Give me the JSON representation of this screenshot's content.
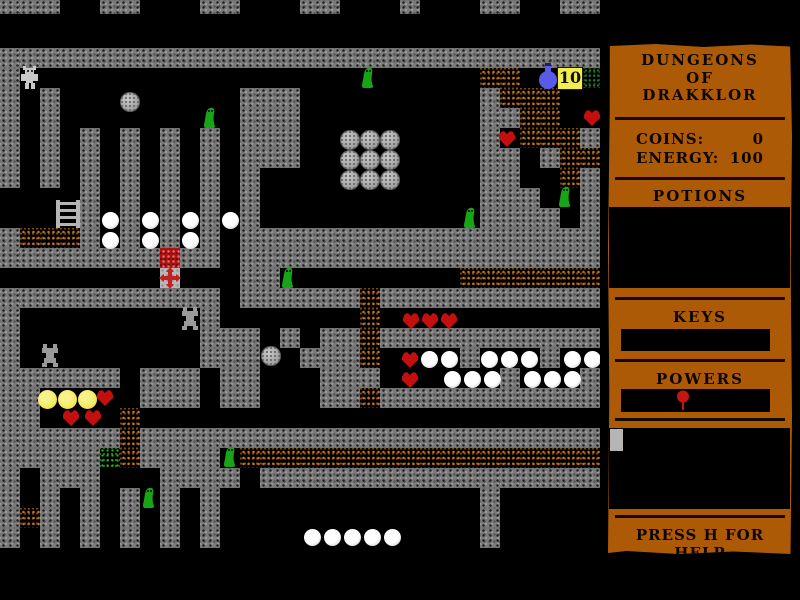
{
  "window": {
    "width": 800,
    "height": 600,
    "background": "#000000"
  },
  "sidebar": {
    "title_lines": [
      "DUNGEONS",
      "OF",
      "DRAKKLOR"
    ],
    "stats": [
      {
        "label": "COINS:",
        "value": "0"
      },
      {
        "label": "ENERGY:",
        "value": "100"
      }
    ],
    "potions_heading": "POTIONS",
    "keys_heading": "KEYS",
    "powers_heading": "POWERS",
    "help_text": "PRESS H FOR HELP",
    "power_icon": "red-balloon-icon",
    "panel_color": "#ad5a07"
  },
  "hud": {
    "potion_count": "10"
  },
  "colors": {
    "panel": "#ad5a07",
    "divider": "#140a00",
    "text": "#0c0500",
    "box": "#000000",
    "cursor": "#b5b5b5",
    "wall_base": "#7b7b7b",
    "rubble_speck": "#c9731a",
    "green_speck": "#2db52d",
    "dark_green_speck": "#1f7a1f",
    "red_tile": "#a81212",
    "gray_tile": "#b8b8b8",
    "heart": "#c40f0f",
    "slime": "#17a417",
    "slime_eye": "#0a2a0a",
    "coin": "#f2e84e",
    "egg": "#f8f8f8",
    "boulder": "#ababab",
    "player": "#c8c8c8",
    "spider": "#9a9a9a",
    "flask": "#5a5ae8",
    "flask_cap": "#202060",
    "badge_bg": "#f3ee4e",
    "badge_text": "#111111",
    "balloon": "#c41414",
    "ladder": "#b5b5b5",
    "cross": "#c42020"
  },
  "map": {
    "tile_size": 20,
    "cols": 30,
    "row_y_offset": -12,
    "legend": {
      "#": "wall",
      ".": "floor",
      "o": "rubble",
      "g": "green-speckle",
      "D": "dark-green-speckle",
      "%": "red-chest",
      "+": "cross-base"
    },
    "rows": [
      "###..##...##...##...#...##..##",
      "..............................",
      "..............................",
      "##############################",
      "#.......................oo...D",
      "#.#.........###.........#ooo..",
      "#.#.........###.........##oo..",
      "#.#.#.#.#.#.###.........#.ooo#",
      "#.#.#.#.#.#.###.........##.#oo",
      "#.#.#.#.#.#.#...........##..o#",
      "....#.#.#.#.#...........###..#",
      "....#.#.#.#.#...........####.#",
      "#ooo#.#.#.#.##################",
      "########%##.##################",
      "........+...##.........ooooooo",
      "###########.######o###########",
      "#.........#.......o...........",
      "#.........###.#.##o###########",
      "#.........###..###o....#...#..",
      "######.###.##...###......#...#",
      "##.....###.##...##o###########",
      "##....o.......................",
      "######o#######################",
      "#####go####.oooooooooooooooooo",
      "#.###...####.#################",
      "#.#.#.#.#.#.............#.....",
      "#o#.#.#.#.#.............#.....",
      "#.#.#.#.#.#.............#.....",
      "..............................",
      "..............................",
      ".............................."
    ],
    "entities": [
      {
        "type": "player",
        "x": 21,
        "y": 66
      },
      {
        "type": "slime",
        "x": 202,
        "y": 106
      },
      {
        "type": "slime",
        "x": 360,
        "y": 66
      },
      {
        "type": "slime",
        "x": 462,
        "y": 206
      },
      {
        "type": "slime",
        "x": 557,
        "y": 185
      },
      {
        "type": "slime",
        "x": 280,
        "y": 266
      },
      {
        "type": "slime",
        "x": 222,
        "y": 445
      },
      {
        "type": "slime",
        "x": 141,
        "y": 486
      },
      {
        "type": "spider",
        "x": 179,
        "y": 307
      },
      {
        "type": "spider",
        "x": 39,
        "y": 344
      },
      {
        "type": "boulder",
        "x": 120,
        "y": 92
      },
      {
        "type": "boulder",
        "x": 340,
        "y": 130
      },
      {
        "type": "boulder",
        "x": 360,
        "y": 130
      },
      {
        "type": "boulder",
        "x": 380,
        "y": 130
      },
      {
        "type": "boulder",
        "x": 340,
        "y": 150
      },
      {
        "type": "boulder",
        "x": 360,
        "y": 150
      },
      {
        "type": "boulder",
        "x": 380,
        "y": 150
      },
      {
        "type": "boulder",
        "x": 340,
        "y": 170
      },
      {
        "type": "boulder",
        "x": 360,
        "y": 170
      },
      {
        "type": "boulder",
        "x": 380,
        "y": 170
      },
      {
        "type": "boulder",
        "x": 261,
        "y": 346
      },
      {
        "type": "egg",
        "x": 102,
        "y": 212
      },
      {
        "type": "egg",
        "x": 142,
        "y": 212
      },
      {
        "type": "egg",
        "x": 182,
        "y": 212
      },
      {
        "type": "egg",
        "x": 222,
        "y": 212
      },
      {
        "type": "egg",
        "x": 102,
        "y": 232
      },
      {
        "type": "egg",
        "x": 142,
        "y": 232
      },
      {
        "type": "egg",
        "x": 182,
        "y": 232
      },
      {
        "type": "egg",
        "x": 421,
        "y": 351
      },
      {
        "type": "egg",
        "x": 441,
        "y": 351
      },
      {
        "type": "egg",
        "x": 481,
        "y": 351
      },
      {
        "type": "egg",
        "x": 501,
        "y": 351
      },
      {
        "type": "egg",
        "x": 521,
        "y": 351
      },
      {
        "type": "egg",
        "x": 564,
        "y": 351
      },
      {
        "type": "egg",
        "x": 584,
        "y": 351
      },
      {
        "type": "egg",
        "x": 444,
        "y": 371
      },
      {
        "type": "egg",
        "x": 464,
        "y": 371
      },
      {
        "type": "egg",
        "x": 484,
        "y": 371
      },
      {
        "type": "egg",
        "x": 524,
        "y": 371
      },
      {
        "type": "egg",
        "x": 544,
        "y": 371
      },
      {
        "type": "egg",
        "x": 564,
        "y": 371
      },
      {
        "type": "egg",
        "x": 304,
        "y": 529
      },
      {
        "type": "egg",
        "x": 324,
        "y": 529
      },
      {
        "type": "egg",
        "x": 344,
        "y": 529
      },
      {
        "type": "egg",
        "x": 364,
        "y": 529
      },
      {
        "type": "egg",
        "x": 384,
        "y": 529
      },
      {
        "type": "heart",
        "x": 582,
        "y": 108
      },
      {
        "type": "heart",
        "x": 497,
        "y": 129
      },
      {
        "type": "heart",
        "x": 401,
        "y": 311
      },
      {
        "type": "heart",
        "x": 420,
        "y": 311
      },
      {
        "type": "heart",
        "x": 439,
        "y": 311
      },
      {
        "type": "heart",
        "x": 400,
        "y": 350
      },
      {
        "type": "heart",
        "x": 400,
        "y": 370
      },
      {
        "type": "heart",
        "x": 95,
        "y": 388
      },
      {
        "type": "heart",
        "x": 61,
        "y": 408
      },
      {
        "type": "heart",
        "x": 83,
        "y": 408
      },
      {
        "type": "coin",
        "x": 38,
        "y": 390
      },
      {
        "type": "coin",
        "x": 58,
        "y": 390
      },
      {
        "type": "coin",
        "x": 78,
        "y": 390
      },
      {
        "type": "flask",
        "x": 537,
        "y": 63
      },
      {
        "type": "count-badge",
        "x": 557,
        "y": 67
      },
      {
        "type": "ladder",
        "x": 55,
        "y": 200
      },
      {
        "type": "cross",
        "x": 159,
        "y": 267
      }
    ]
  }
}
